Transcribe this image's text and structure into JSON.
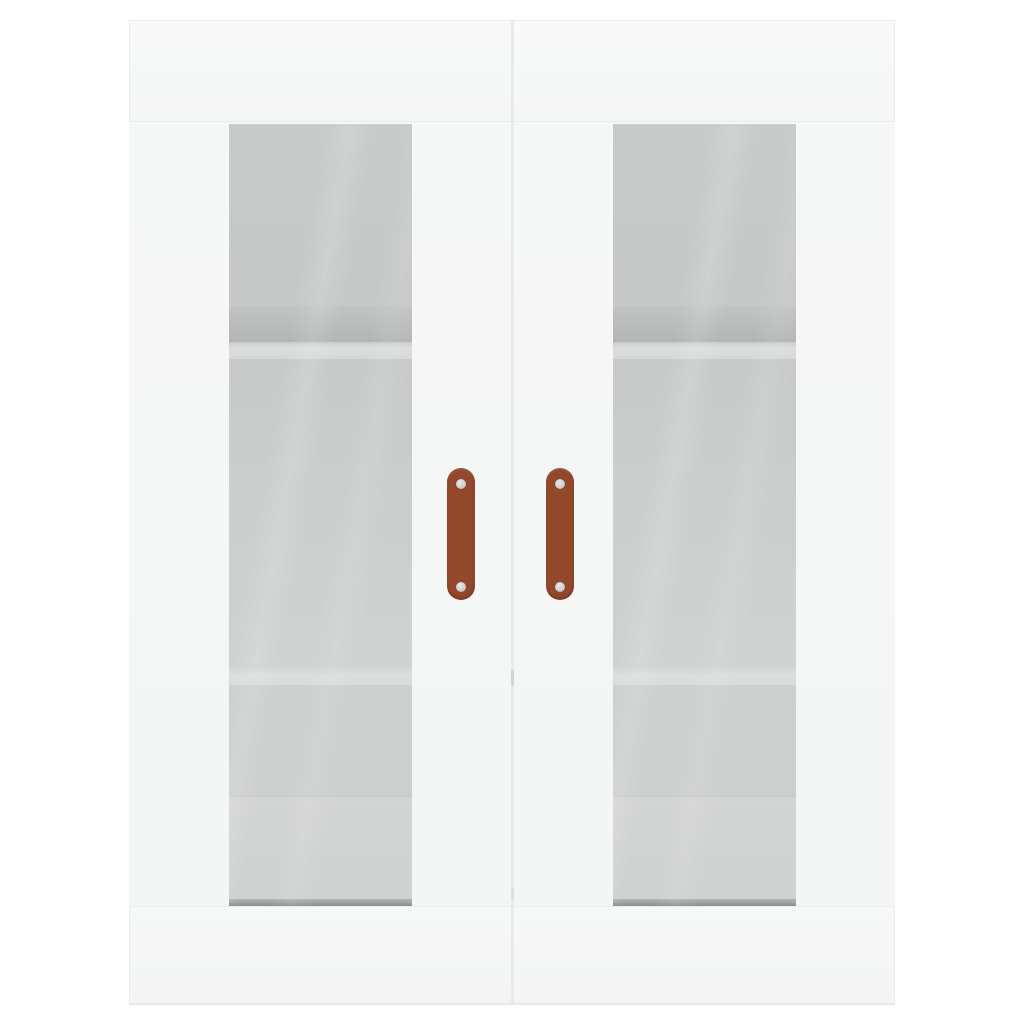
{
  "image": {
    "type": "product-photo",
    "subject": "Two white wall-mounted display cabinets with glass doors, shown side by side on a plain white background",
    "background_color": "#ffffff"
  },
  "cabinet": {
    "unit_count": 2,
    "body_color": "#f6f7f7",
    "edge_line_color": "#e9eaea",
    "doors_per_unit": 1,
    "door_style": "framed glass panel",
    "visible_shelves_per_unit": 2
  },
  "glass": {
    "tint_top_compartment": "#c9cbcb",
    "tint_middle_compartment": "#d0d2d2",
    "shelf_front_edge_highlight": "#dcdede",
    "shelf_underside_shadow": "#b3b5b5",
    "glass_bottom_edge": "#8d8f8f"
  },
  "handles": {
    "count": 2,
    "orientation": "vertical",
    "shape": "rounded strap / pill",
    "material_color": "#93472b",
    "screws_per_handle": 2,
    "screw_color": "#c6c8c8"
  }
}
